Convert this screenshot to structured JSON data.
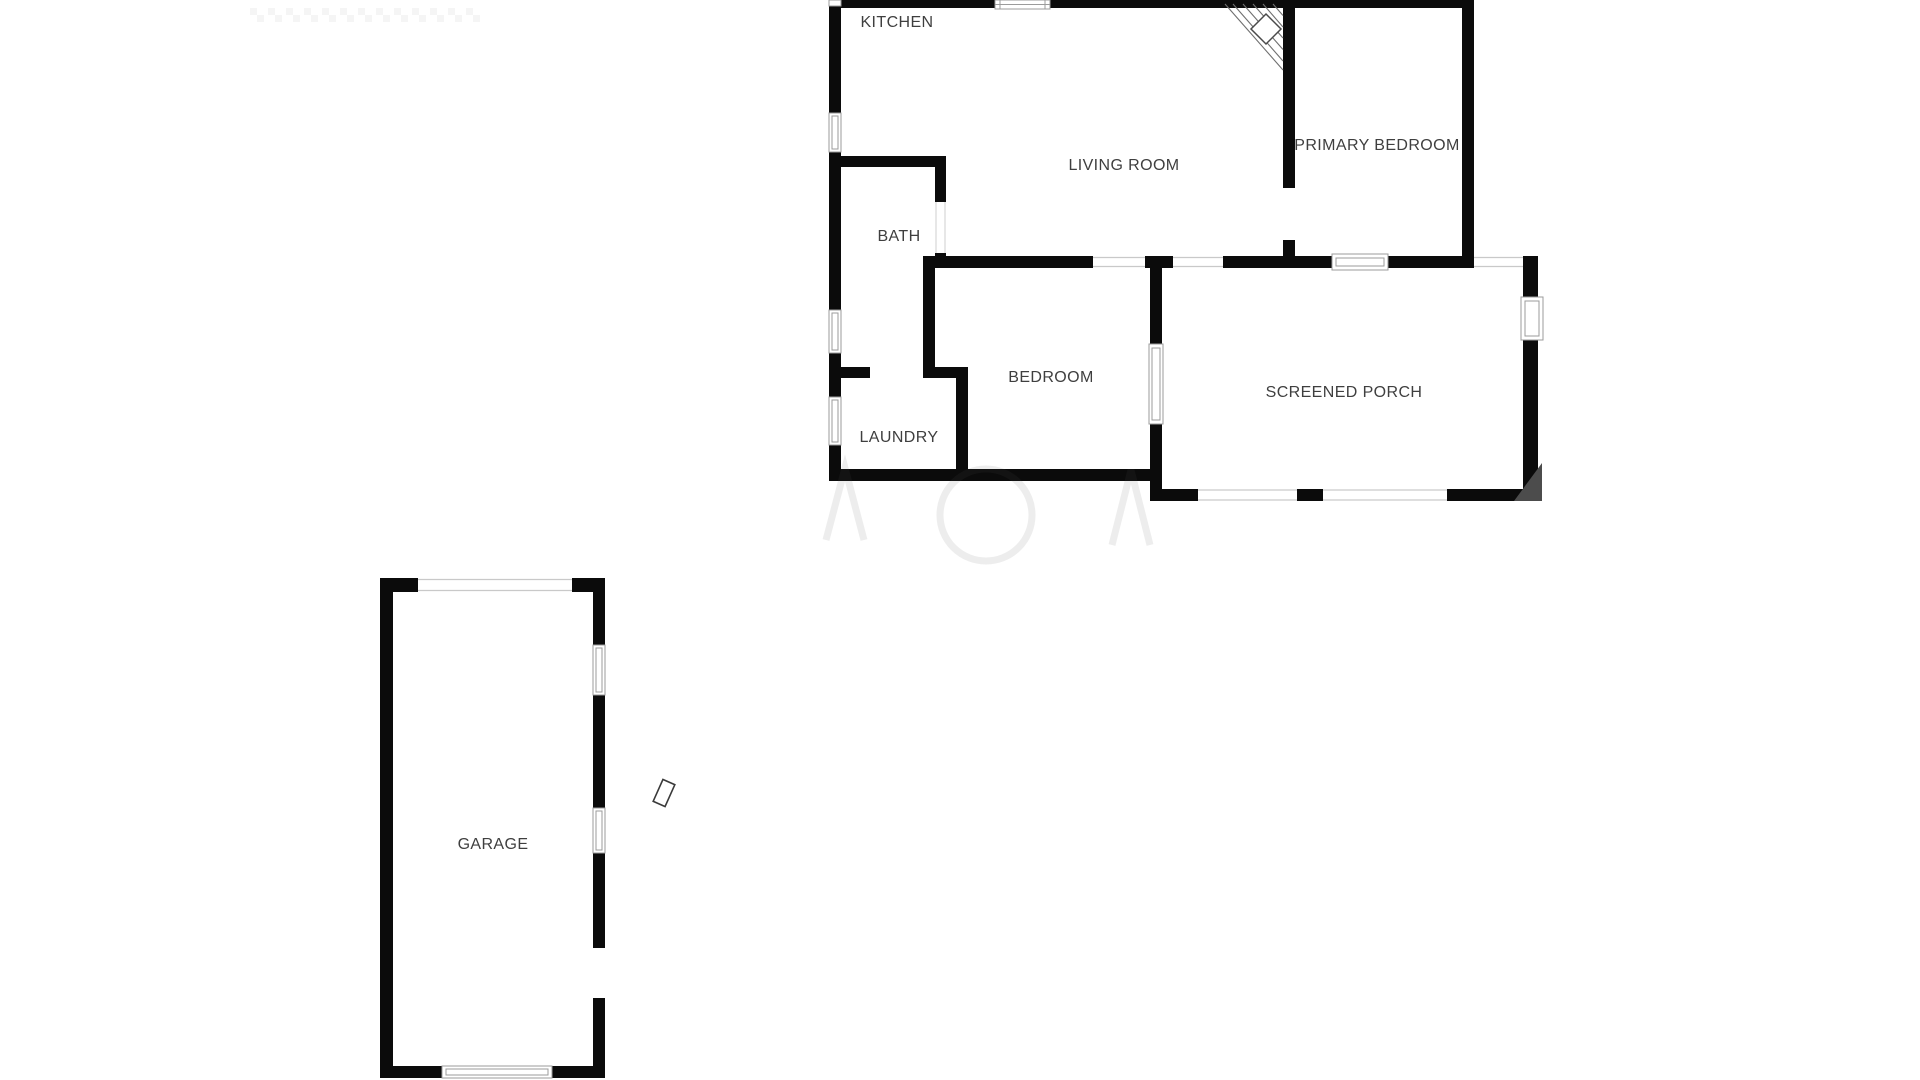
{
  "image": {
    "kind": "residential floor plan screenshot",
    "background": "#ffffff",
    "width": 1920,
    "height": 1080
  },
  "floor_plan": {
    "rooms": {
      "kitchen": {
        "label": "KITCHEN"
      },
      "living_room": {
        "label": "LIVING ROOM"
      },
      "primary_bedroom": {
        "label": "PRIMARY BEDROOM"
      },
      "bath": {
        "label": "BATH"
      },
      "bedroom": {
        "label": "BEDROOM"
      },
      "laundry": {
        "label": "LAUNDRY"
      },
      "screened_porch": {
        "label": "SCREENED PORCH"
      },
      "garage": {
        "label": "GARAGE"
      }
    },
    "colors": {
      "wall": "#0b0b0b",
      "window_frame": "#9b9b9b",
      "opening_line": "#c9c9c9",
      "label_text": "#3f3f3f",
      "stairs_hatch": "#6e6e6e",
      "corner_shade": "#4c4c4c"
    },
    "symbols": {
      "stairs": "corner-winder-stairs-with-diamond-landing",
      "door_openings": [
        "bath-door",
        "laundry-door",
        "primary-bedroom-door",
        "garage-side-door"
      ],
      "screened_openings": 5,
      "windows": 9,
      "garage_door": "garage-door-panel",
      "detached_symbol": "small-rotated-door-leaf"
    }
  }
}
